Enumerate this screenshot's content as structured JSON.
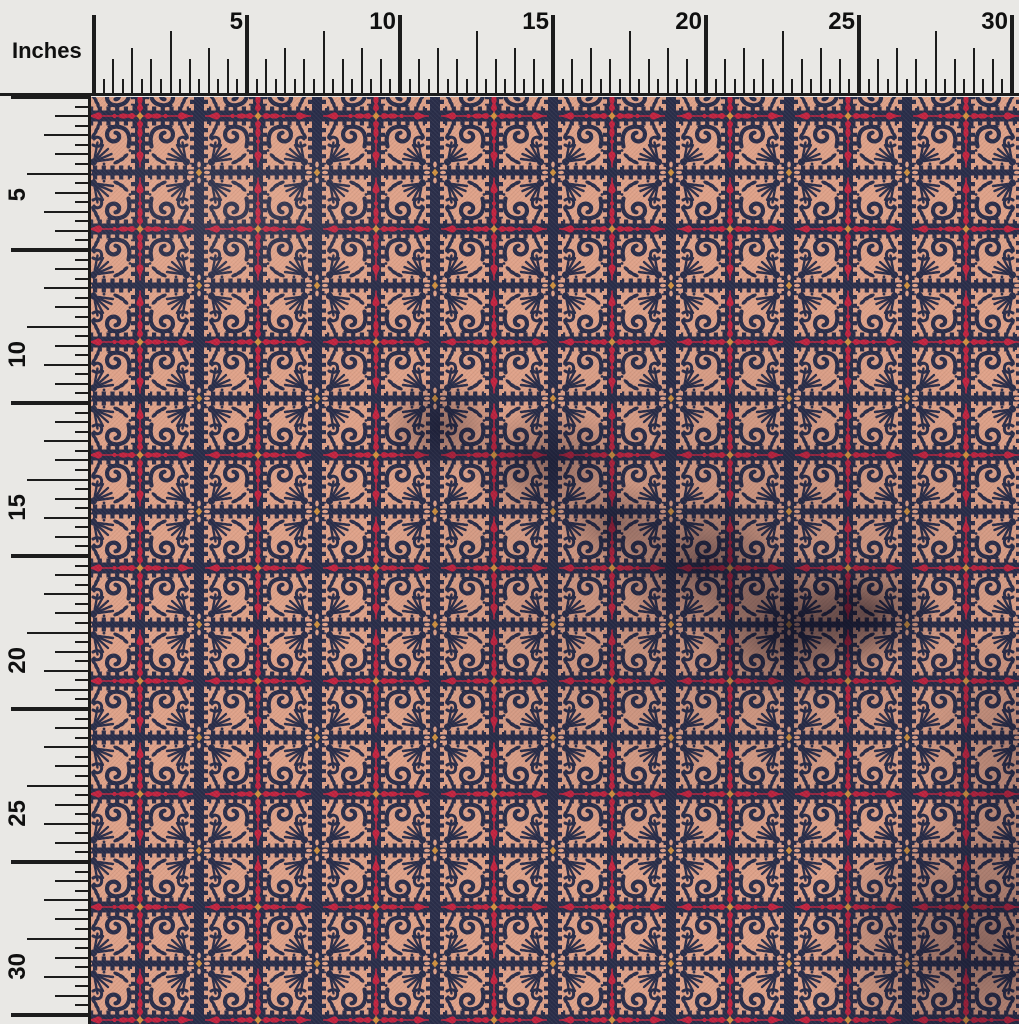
{
  "photo": {
    "subject": "Block-print style fabric swatch photographed under top and left inch rulers",
    "pattern_description": "Grid of peach ornamental square tiles with navy curl, fan and leaf motifs on a navy ground; every other gridline carries a red floral chain with drops, arrows and hearts, orange dots at crossings; fabric shows soft wrinkle shadows in the middle-right and lower-right."
  },
  "ruler": {
    "unit_label": "Inches",
    "top_labels": [
      "5",
      "10",
      "15",
      "20",
      "25",
      "30"
    ],
    "left_labels": [
      "5",
      "10",
      "15",
      "20",
      "25",
      "30"
    ],
    "ink_color": "#1c1c1c",
    "background_color": "#e9e8e5"
  },
  "fabric_colors": {
    "navy": "#2a2e4a",
    "peach": "#dfa289",
    "red": "#c22440",
    "dark_red": "#9e1e34",
    "orange": "#d09240"
  }
}
